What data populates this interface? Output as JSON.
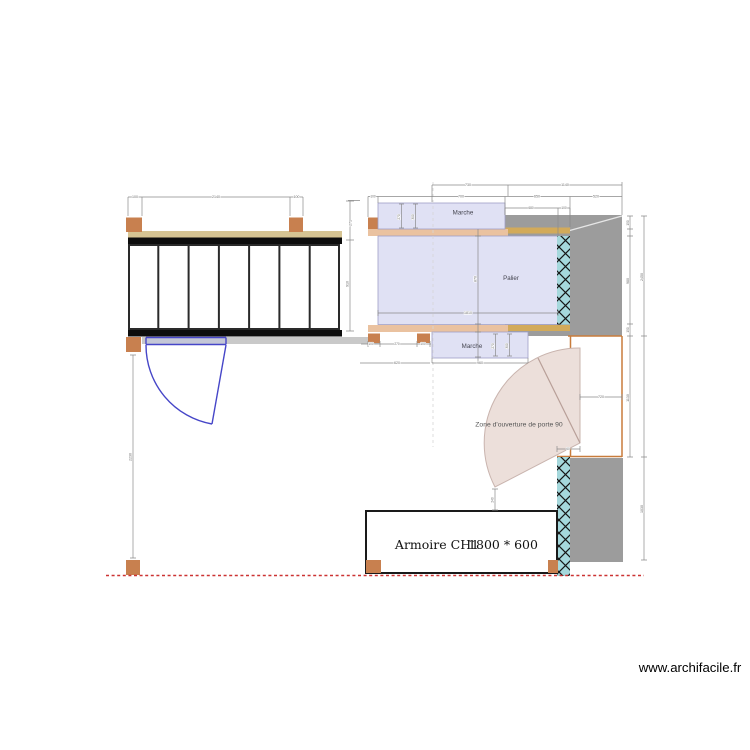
{
  "watermark": "www.archifacile.fr",
  "rooms": {
    "marche_top": "Marche",
    "marche_bottom": "Marche",
    "palier": "Palier"
  },
  "door_zone": {
    "label": "Zone d'ouverture de porte 90"
  },
  "armoire": {
    "name": "Armoire CH1",
    "size": "1800 * 600"
  },
  "colors": {
    "post_brown": "#c8804f",
    "stair_rail_tan": "#d6c493",
    "stair_bar_black": "#0d0d0d",
    "floor_strip_gray": "#c9c9c9",
    "room_fill_lavender": "#e0e1f4",
    "room_border": "#9f9fc6",
    "strip_salmon": "#eac2a0",
    "strip_gold": "#d2aa5a",
    "wall_gray": "#9c9c9c",
    "insulation_teal": "#a5d8dc",
    "wall_orange": "#c87c3c",
    "door_blue": "#4646c8",
    "door_fan_pink": "#ecdfda",
    "limit_red": "#cc3333",
    "dim_gray": "#8a8a8a"
  },
  "dims": {
    "stair_left": "100",
    "stair_span": "2140",
    "stair_right": "100",
    "stair_side_a": "271",
    "stair_side_b": "910",
    "gap": "100",
    "top_a": "730",
    "top_b": "1140",
    "mid_a": "700",
    "mid_b": "650",
    "mid_c": "520",
    "wall_a": "680",
    "wall_b": "100",
    "marche_top_d1": "270",
    "marche_top_d2": "300",
    "palier_h": "870",
    "palier_w": "1810",
    "marche_bot_d1": "270",
    "marche_bot_d2": "300",
    "marche_bot_w": "960",
    "row_a": "100",
    "row_b": "270",
    "row_c": "100",
    "left_seg": "620",
    "doorway_w": "720",
    "pivot_off": "60",
    "right_a1": "150",
    "right_a2": "980",
    "right_a3": "150",
    "right_a4": "1130",
    "right_b1": "2450",
    "right_b2": "1030",
    "fan_tip": "240",
    "left_wall": "2230"
  }
}
